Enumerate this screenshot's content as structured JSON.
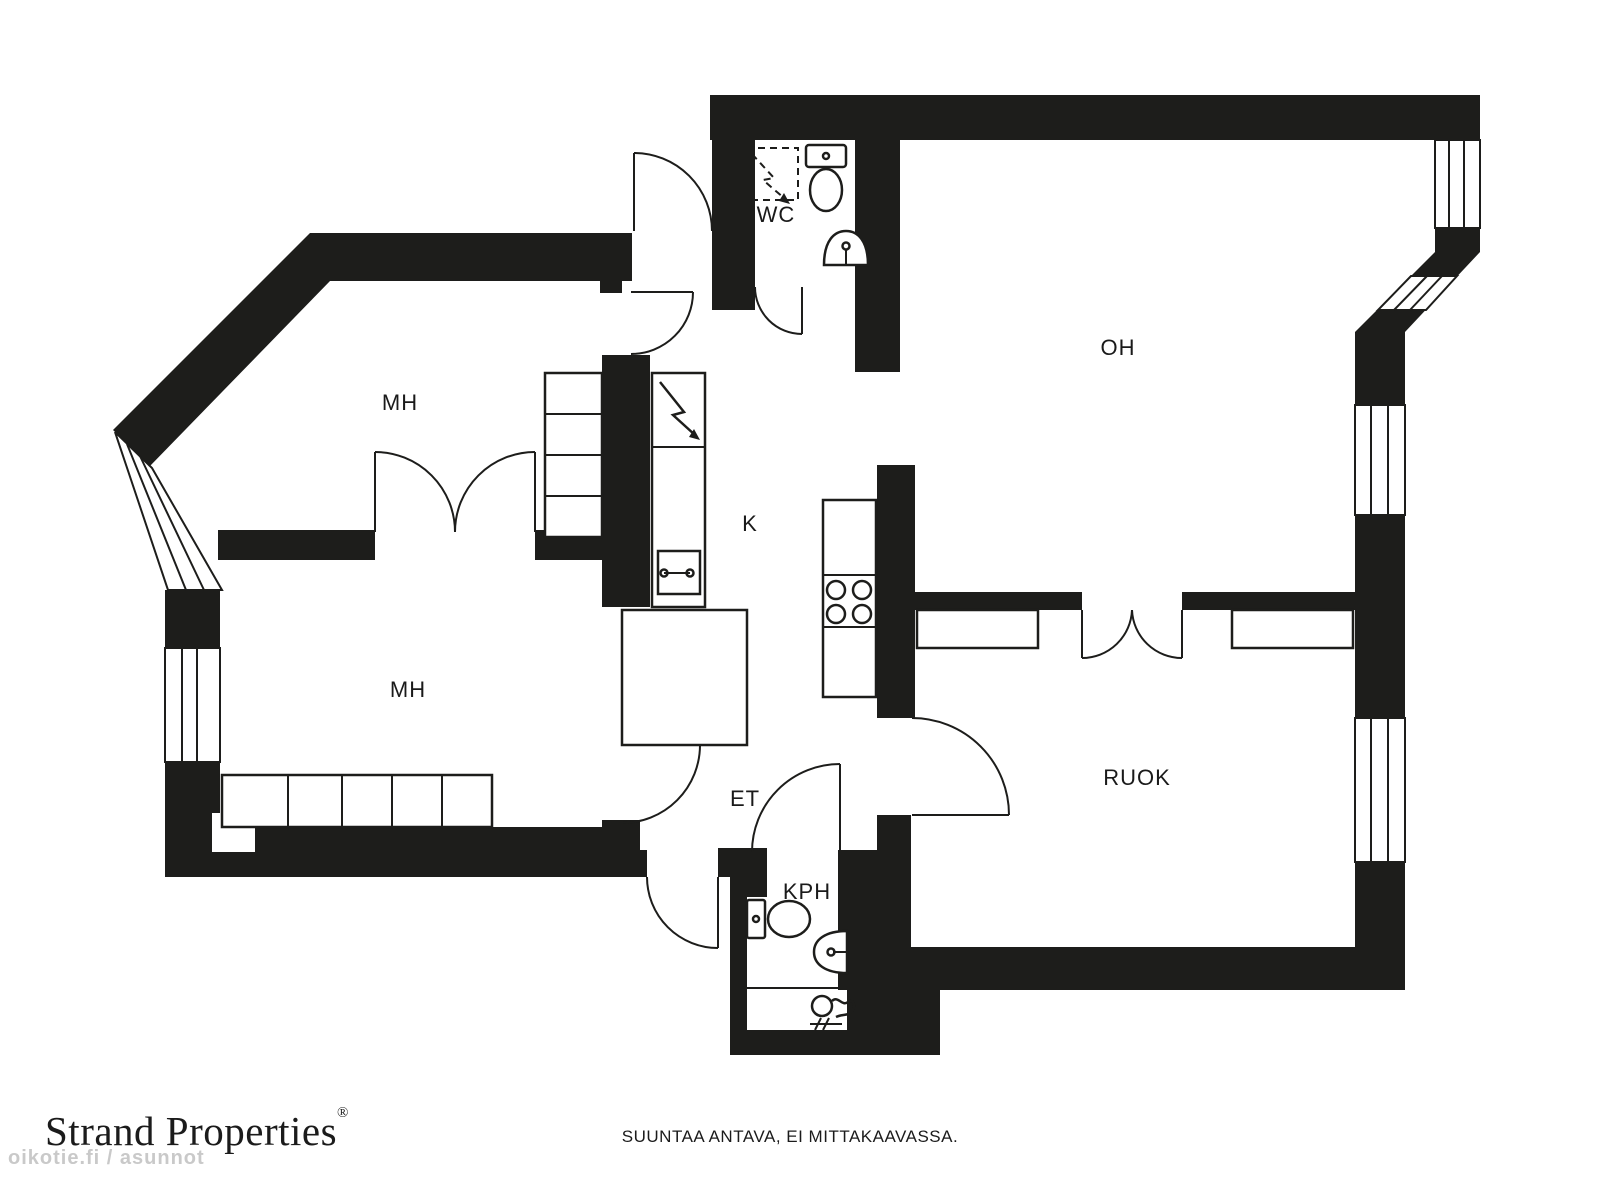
{
  "floorplan": {
    "rooms": [
      {
        "id": "mh-upper",
        "label": "MH"
      },
      {
        "id": "mh-lower",
        "label": "MH"
      },
      {
        "id": "wc",
        "label": "WC"
      },
      {
        "id": "oh",
        "label": "OH"
      },
      {
        "id": "k",
        "label": "K"
      },
      {
        "id": "et",
        "label": "ET"
      },
      {
        "id": "kph",
        "label": "KPH"
      },
      {
        "id": "ruok",
        "label": "RUOK"
      }
    ],
    "colors": {
      "wall": "#1d1d1b",
      "line": "#1d1d1b",
      "background": "#ffffff"
    }
  },
  "footer": {
    "brand": "Strand Properties",
    "brand_registered": "®",
    "disclaimer": "SUUNTAA ANTAVA, EI MITTAKAAVASSA.",
    "watermark": "oikotie.fi / asunnot"
  }
}
